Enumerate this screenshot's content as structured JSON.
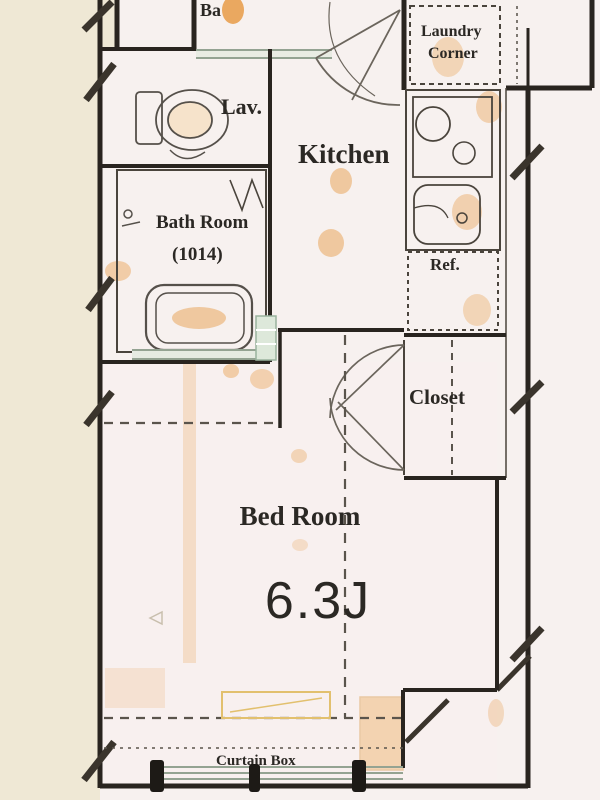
{
  "title": "apartment-floor-plan",
  "labels": {
    "partial_top": "Ba",
    "lav": "Lav.",
    "kitchen": "Kitchen",
    "laundry_line1": "Laundry",
    "laundry_line2": "Corner",
    "bath_room": "Bath Room",
    "bath_size": "(1014)",
    "ref": "Ref.",
    "closet": "Closet",
    "bedroom": "Bed Room",
    "bedroom_size": "6.3J",
    "curtain_box": "Curtain Box"
  },
  "rooms": [
    {
      "name": "Lav."
    },
    {
      "name": "Bath Room",
      "size": "(1014)"
    },
    {
      "name": "Kitchen"
    },
    {
      "name": "Laundry Corner"
    },
    {
      "name": "Ref."
    },
    {
      "name": "Closet"
    },
    {
      "name": "Bed Room",
      "size": "6.3J"
    }
  ],
  "colors": {
    "wall": "#29241f",
    "background": "#f7f1ef",
    "outside_left": "#efe8d5",
    "stain_orange": "#e8a050",
    "window_green": "#94a392",
    "dash_gray": "#5a544c"
  }
}
